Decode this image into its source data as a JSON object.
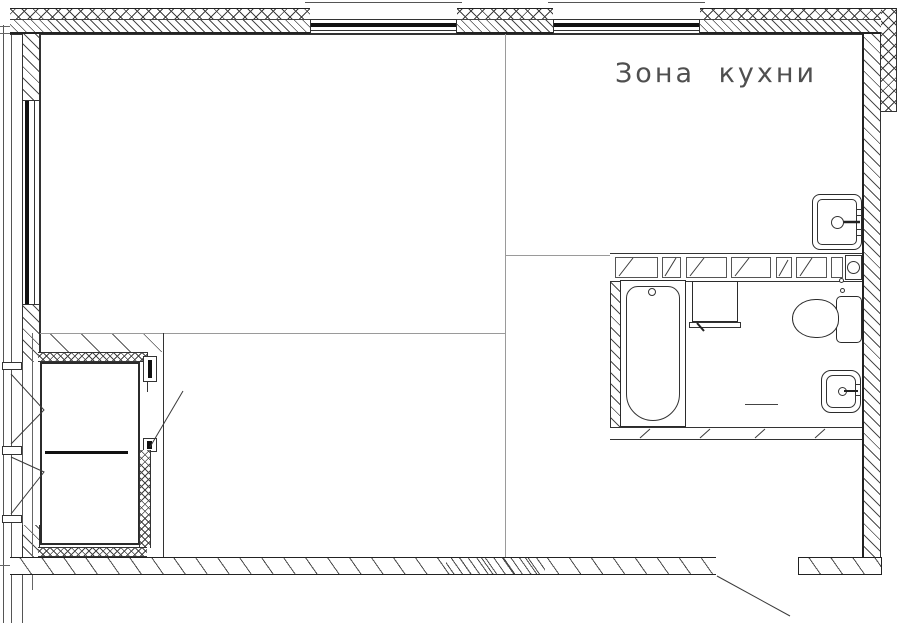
{
  "plan": {
    "type": "apartment-floor-plan",
    "language": "ru",
    "labels": {
      "kitchen_zone": "Зона кухни"
    }
  },
  "colors": {
    "background": "#ffffff",
    "wall_line": "#2b2b2b",
    "hatch": "#4b4b4b",
    "divider": "#9a9a9a",
    "glazing": "#111111",
    "label_text": "#4f4f4f"
  },
  "fixtures": {
    "bathtub": "bathtub-icon",
    "washing_machine": "washing-machine-icon",
    "toilet": "toilet-icon",
    "bathroom_sink": "washbasin-icon",
    "kitchen_sink": "kitchen-sink-icon",
    "riser_pipe": "pipe-riser-icon",
    "top_windows": "window-icon",
    "left_window": "window-icon",
    "balcony_door": "double-door-icon",
    "closet_door": "swing-door-icon"
  }
}
